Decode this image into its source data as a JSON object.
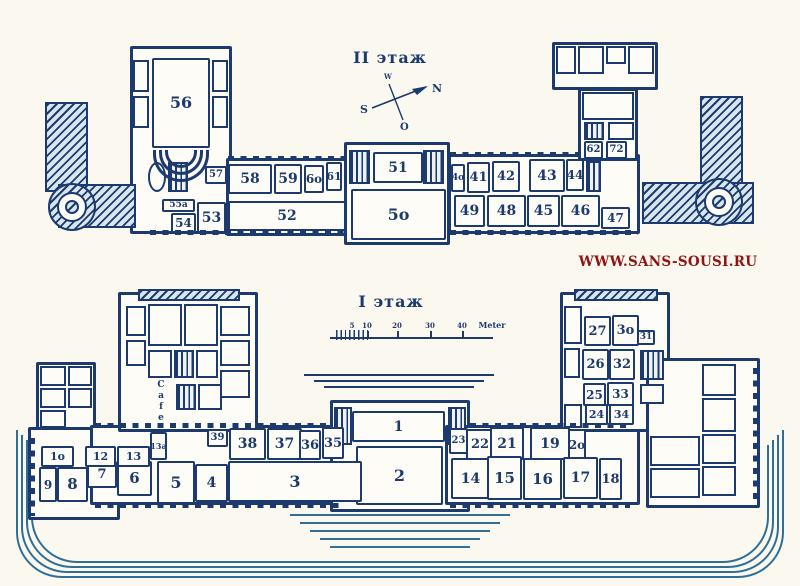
{
  "colors": {
    "ink": "#1c3a6e",
    "paper": "#faf8ef",
    "room_fill": "#fdfcf6",
    "hatch_fill": "#d7e6ee",
    "terrace": "#2f6e96",
    "watermark": "#8e1414"
  },
  "watermark": {
    "text": "WWW.SANS-SOUSI.RU"
  },
  "upper_floor": {
    "title": "II этаж",
    "compass": {
      "north": "N",
      "south": "S",
      "east": "O",
      "west": "W"
    },
    "rooms": [
      {
        "id": "56",
        "label": "56",
        "x": 152,
        "y": 58,
        "w": 58,
        "h": 90,
        "fs": 16
      },
      {
        "id": "57",
        "label": "57",
        "x": 205,
        "y": 166,
        "w": 22,
        "h": 18,
        "fs": 10
      },
      {
        "id": "58",
        "label": "58",
        "x": 228,
        "y": 164,
        "w": 44,
        "h": 30,
        "fs": 14
      },
      {
        "id": "59",
        "label": "59",
        "x": 274,
        "y": 164,
        "w": 28,
        "h": 30,
        "fs": 14
      },
      {
        "id": "60",
        "label": "6o",
        "x": 304,
        "y": 165,
        "w": 20,
        "h": 28,
        "fs": 12
      },
      {
        "id": "61",
        "label": "61",
        "x": 326,
        "y": 162,
        "w": 16,
        "h": 29,
        "fs": 11
      },
      {
        "id": "55a",
        "label": "55a",
        "x": 162,
        "y": 199,
        "w": 33,
        "h": 13,
        "fs": 9
      },
      {
        "id": "54",
        "label": "54",
        "x": 171,
        "y": 213,
        "w": 25,
        "h": 20,
        "fs": 12
      },
      {
        "id": "53",
        "label": "53",
        "x": 197,
        "y": 202,
        "w": 29,
        "h": 31,
        "fs": 14
      },
      {
        "id": "52",
        "label": "52",
        "x": 228,
        "y": 201,
        "w": 118,
        "h": 30,
        "fs": 14
      },
      {
        "id": "51",
        "label": "51",
        "x": 373,
        "y": 152,
        "w": 50,
        "h": 31,
        "fs": 14
      },
      {
        "id": "50",
        "label": "5o",
        "x": 351,
        "y": 189,
        "w": 95,
        "h": 51,
        "fs": 16
      },
      {
        "id": "40",
        "label": "4o",
        "x": 451,
        "y": 164,
        "w": 14,
        "h": 28,
        "fs": 9
      },
      {
        "id": "41",
        "label": "41",
        "x": 467,
        "y": 162,
        "w": 23,
        "h": 31,
        "fs": 13
      },
      {
        "id": "42",
        "label": "42",
        "x": 492,
        "y": 161,
        "w": 28,
        "h": 31,
        "fs": 13
      },
      {
        "id": "43",
        "label": "43",
        "x": 529,
        "y": 159,
        "w": 36,
        "h": 33,
        "fs": 14
      },
      {
        "id": "44",
        "label": "44",
        "x": 566,
        "y": 159,
        "w": 18,
        "h": 32,
        "fs": 12
      },
      {
        "id": "62",
        "label": "62",
        "x": 584,
        "y": 141,
        "w": 19,
        "h": 18,
        "fs": 10
      },
      {
        "id": "72",
        "label": "72",
        "x": 606,
        "y": 141,
        "w": 21,
        "h": 18,
        "fs": 10
      },
      {
        "id": "49",
        "label": "49",
        "x": 454,
        "y": 195,
        "w": 31,
        "h": 32,
        "fs": 14
      },
      {
        "id": "48",
        "label": "48",
        "x": 487,
        "y": 195,
        "w": 39,
        "h": 32,
        "fs": 14
      },
      {
        "id": "45",
        "label": "45",
        "x": 527,
        "y": 195,
        "w": 33,
        "h": 32,
        "fs": 14
      },
      {
        "id": "46",
        "label": "46",
        "x": 561,
        "y": 195,
        "w": 39,
        "h": 32,
        "fs": 14
      },
      {
        "id": "47",
        "label": "47",
        "x": 601,
        "y": 207,
        "w": 29,
        "h": 22,
        "fs": 12
      }
    ]
  },
  "lower_floor": {
    "title": "I этаж",
    "cafe": "Cafe",
    "scale": {
      "unit": "Meter"
    },
    "texts": [
      {
        "id": "scale-5",
        "label": "5",
        "x": 352,
        "y": 321,
        "fs": 7
      },
      {
        "id": "scale-10",
        "label": "10",
        "x": 367,
        "y": 321,
        "fs": 7
      },
      {
        "id": "scale-20",
        "label": "20",
        "x": 397,
        "y": 321,
        "fs": 7
      },
      {
        "id": "scale-30",
        "label": "30",
        "x": 430,
        "y": 321,
        "fs": 7
      },
      {
        "id": "scale-40",
        "label": "40",
        "x": 462,
        "y": 321,
        "fs": 7
      },
      {
        "id": "scale-unit",
        "label": "Meter",
        "x": 492,
        "y": 320,
        "fs": 8
      }
    ],
    "rooms": [
      {
        "id": "1",
        "label": "1",
        "x": 352,
        "y": 411,
        "w": 93,
        "h": 31,
        "fs": 14
      },
      {
        "id": "2",
        "label": "2",
        "x": 356,
        "y": 446,
        "w": 87,
        "h": 59,
        "fs": 16
      },
      {
        "id": "3",
        "label": "3",
        "x": 228,
        "y": 461,
        "w": 134,
        "h": 41,
        "fs": 16
      },
      {
        "id": "4",
        "label": "4",
        "x": 195,
        "y": 464,
        "w": 33,
        "h": 38,
        "fs": 14
      },
      {
        "id": "5",
        "label": "5",
        "x": 157,
        "y": 461,
        "w": 38,
        "h": 43,
        "fs": 16
      },
      {
        "id": "6",
        "label": "6",
        "x": 117,
        "y": 461,
        "w": 35,
        "h": 35,
        "fs": 15
      },
      {
        "id": "7",
        "label": "7",
        "x": 87,
        "y": 461,
        "w": 30,
        "h": 27,
        "fs": 13
      },
      {
        "id": "8",
        "label": "8",
        "x": 57,
        "y": 467,
        "w": 31,
        "h": 35,
        "fs": 15
      },
      {
        "id": "9",
        "label": "9",
        "x": 39,
        "y": 467,
        "w": 18,
        "h": 35,
        "fs": 12
      },
      {
        "id": "10",
        "label": "1o",
        "x": 41,
        "y": 446,
        "w": 33,
        "h": 21,
        "fs": 11
      },
      {
        "id": "12",
        "label": "12",
        "x": 85,
        "y": 446,
        "w": 31,
        "h": 21,
        "fs": 11
      },
      {
        "id": "13",
        "label": "13",
        "x": 117,
        "y": 446,
        "w": 33,
        "h": 21,
        "fs": 11
      },
      {
        "id": "13a",
        "label": "13a",
        "x": 150,
        "y": 432,
        "w": 17,
        "h": 28,
        "fs": 8
      },
      {
        "id": "39",
        "label": "39",
        "x": 207,
        "y": 429,
        "w": 21,
        "h": 18,
        "fs": 10
      },
      {
        "id": "38",
        "label": "38",
        "x": 229,
        "y": 428,
        "w": 37,
        "h": 32,
        "fs": 14
      },
      {
        "id": "37",
        "label": "37",
        "x": 267,
        "y": 428,
        "w": 35,
        "h": 32,
        "fs": 14
      },
      {
        "id": "36",
        "label": "36",
        "x": 299,
        "y": 430,
        "w": 22,
        "h": 30,
        "fs": 13
      },
      {
        "id": "35",
        "label": "35",
        "x": 322,
        "y": 427,
        "w": 22,
        "h": 32,
        "fs": 13
      },
      {
        "id": "23",
        "label": "23",
        "x": 449,
        "y": 428,
        "w": 19,
        "h": 26,
        "fs": 10
      },
      {
        "id": "22",
        "label": "22",
        "x": 466,
        "y": 429,
        "w": 28,
        "h": 31,
        "fs": 13
      },
      {
        "id": "21",
        "label": "21",
        "x": 490,
        "y": 427,
        "w": 34,
        "h": 33,
        "fs": 14
      },
      {
        "id": "19",
        "label": "19",
        "x": 530,
        "y": 427,
        "w": 40,
        "h": 33,
        "fs": 14
      },
      {
        "id": "20",
        "label": "2o",
        "x": 568,
        "y": 429,
        "w": 18,
        "h": 31,
        "fs": 12
      },
      {
        "id": "14",
        "label": "14",
        "x": 451,
        "y": 458,
        "w": 39,
        "h": 41,
        "fs": 14
      },
      {
        "id": "15",
        "label": "15",
        "x": 487,
        "y": 456,
        "w": 35,
        "h": 44,
        "fs": 15
      },
      {
        "id": "16",
        "label": "16",
        "x": 523,
        "y": 458,
        "w": 39,
        "h": 42,
        "fs": 15
      },
      {
        "id": "17",
        "label": "17",
        "x": 563,
        "y": 457,
        "w": 35,
        "h": 42,
        "fs": 14
      },
      {
        "id": "18",
        "label": "18",
        "x": 599,
        "y": 458,
        "w": 23,
        "h": 42,
        "fs": 13
      },
      {
        "id": "24",
        "label": "24",
        "x": 585,
        "y": 404,
        "w": 23,
        "h": 21,
        "fs": 11
      },
      {
        "id": "34",
        "label": "34",
        "x": 609,
        "y": 404,
        "w": 25,
        "h": 21,
        "fs": 11
      },
      {
        "id": "25",
        "label": "25",
        "x": 583,
        "y": 383,
        "w": 23,
        "h": 23,
        "fs": 12
      },
      {
        "id": "33",
        "label": "33",
        "x": 607,
        "y": 382,
        "w": 27,
        "h": 24,
        "fs": 12
      },
      {
        "id": "26",
        "label": "26",
        "x": 582,
        "y": 349,
        "w": 27,
        "h": 31,
        "fs": 13
      },
      {
        "id": "32",
        "label": "32",
        "x": 609,
        "y": 349,
        "w": 26,
        "h": 31,
        "fs": 13
      },
      {
        "id": "27",
        "label": "27",
        "x": 584,
        "y": 316,
        "w": 27,
        "h": 30,
        "fs": 13
      },
      {
        "id": "30",
        "label": "3o",
        "x": 612,
        "y": 315,
        "w": 27,
        "h": 31,
        "fs": 13
      },
      {
        "id": "31",
        "label": "31",
        "x": 637,
        "y": 330,
        "w": 18,
        "h": 15,
        "fs": 9
      }
    ]
  }
}
